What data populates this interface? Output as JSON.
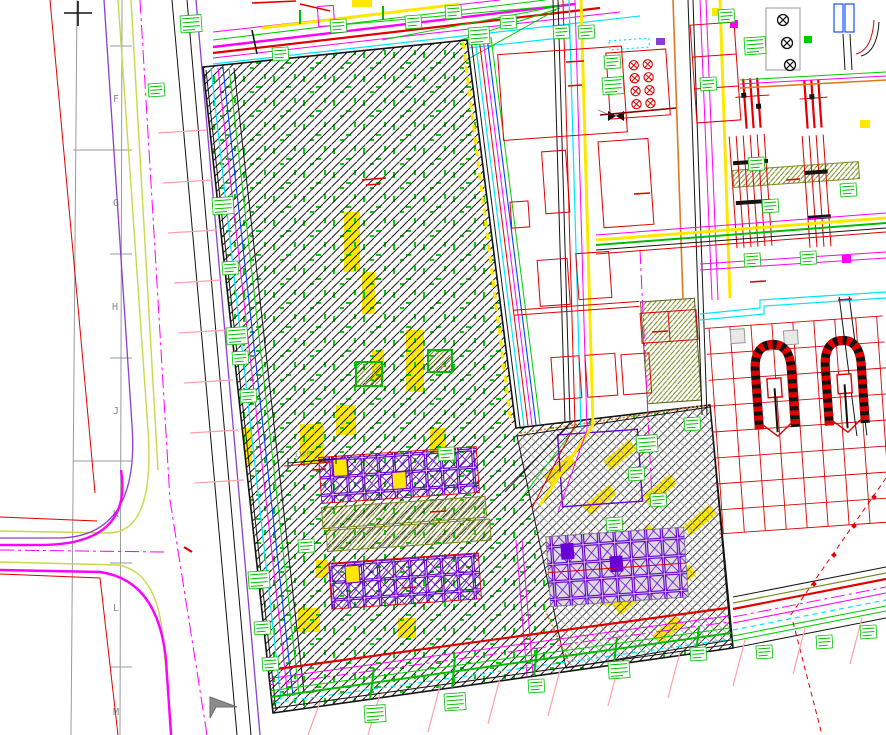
{
  "canvas": {
    "width": 886,
    "height": 735,
    "background": "#ffffff",
    "kind": "CAD site plan viewport"
  },
  "drawing": {
    "grid": {
      "labels": [
        "F",
        "G",
        "H",
        "J",
        "K",
        "L",
        "M"
      ]
    },
    "dimension_label": "1120",
    "regions": {
      "main_hatched_zone": "diagonal-hatched construction area",
      "cross_hatched_yard": "cross-hatched equipment yard",
      "module_rows": "purple crossed-box module rows",
      "plant_area": "dense piping and structures",
      "roads": "west road intersection and south-east road"
    },
    "palette": {
      "red": "#e00000",
      "green": "#00cc00",
      "magenta": "#ff00ff",
      "cyan": "#00e5ff",
      "yellow": "#ffe800",
      "chartreuse": "#c8d84a",
      "purple": "#6a00d8",
      "violet": "#8a3fd0",
      "orange": "#e07820",
      "olive": "#7a8820",
      "pink": "#ffa0a8",
      "blue": "#0040ff",
      "gray": "#9a9a9a",
      "black": "#141414"
    },
    "cursor": {
      "visible": true,
      "x": 214,
      "y": 696
    }
  }
}
